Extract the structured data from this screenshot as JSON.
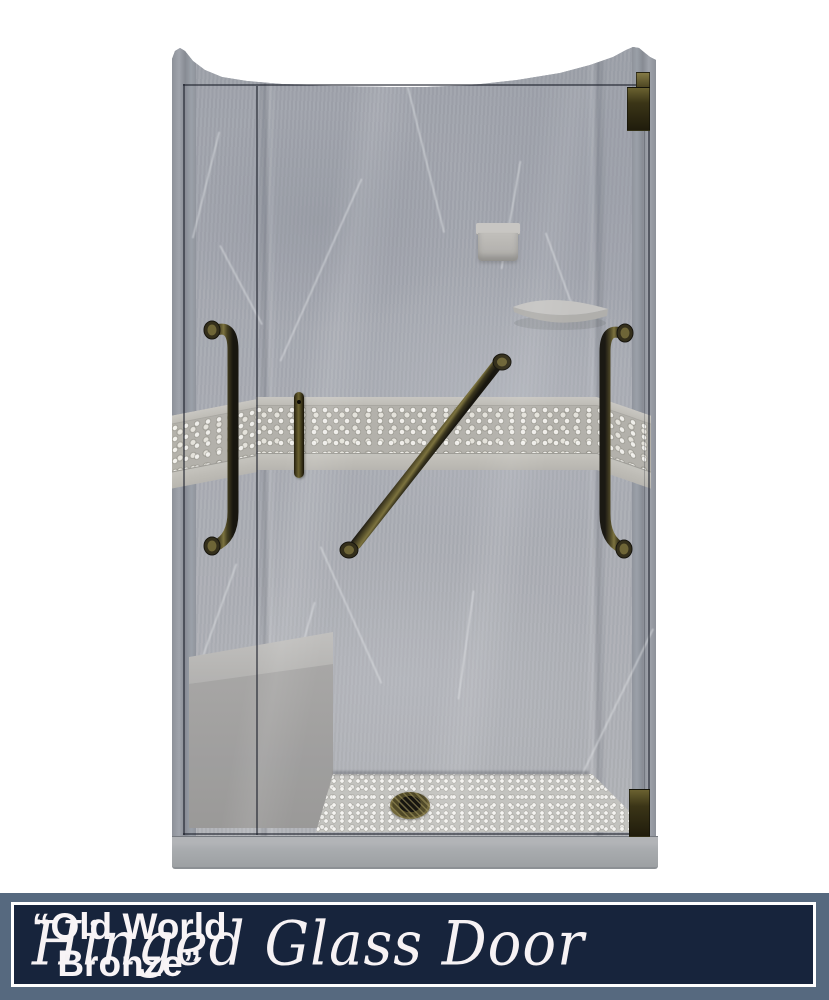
{
  "banner": {
    "product_label": "Hinged Glass Door",
    "finish_line1": "“Old World",
    "finish_line2": "Bronze”",
    "colors": {
      "background": "#17243c",
      "frame": "#56697f",
      "border": "#ffffff",
      "text": "#f8f4f6"
    }
  },
  "product_image": {
    "subject": "alcove shower kit render",
    "wall_finish_color": "#a6a9b0",
    "accent_band_color": "#b4b2aa",
    "hardware_finish_color": "#4f4822",
    "fixtures": [
      "grab-bar-left",
      "grab-bar-diagonal",
      "grab-bar-right",
      "door-handle",
      "door-hinge-top",
      "door-hinge-bottom",
      "soap-dish",
      "corner-shelf",
      "corner-bench",
      "pebble-floor",
      "drain",
      "shower-pan",
      "hinged-glass-door"
    ]
  }
}
